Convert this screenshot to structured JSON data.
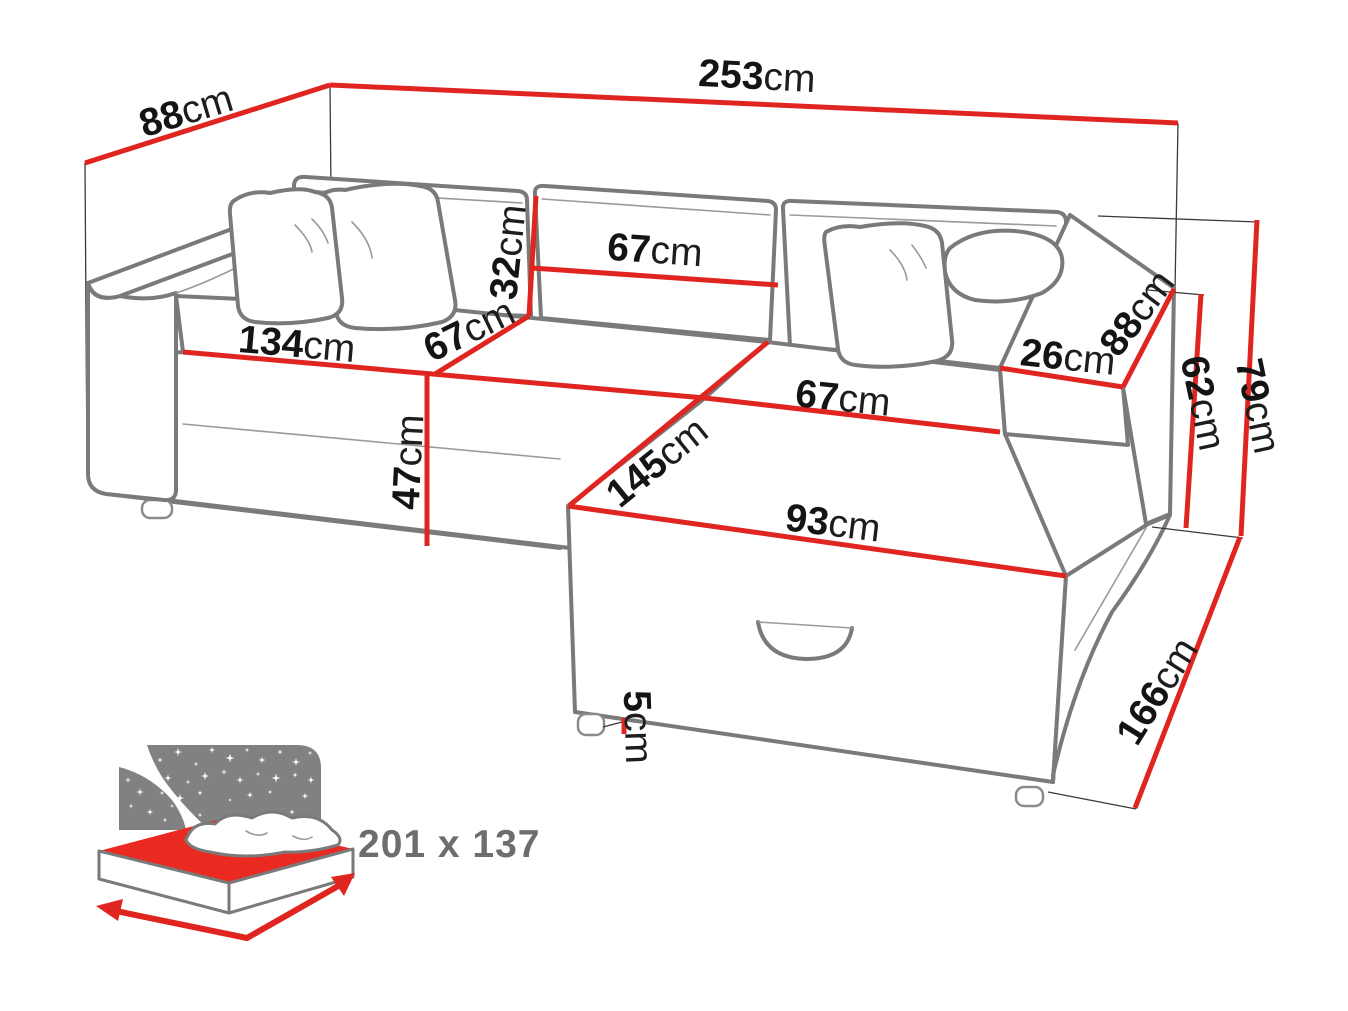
{
  "title": "Corner sofa bed dimension diagram",
  "dims": {
    "total_width": {
      "value": "253",
      "unit": "cm"
    },
    "total_depth": {
      "value": "88",
      "unit": "cm"
    },
    "backrest_height": {
      "value": "32",
      "unit": "cm"
    },
    "backrest_section_width": {
      "value": "67",
      "unit": "cm"
    },
    "seat_front_width": {
      "value": "134",
      "unit": "cm"
    },
    "seat_depth": {
      "value": "67",
      "unit": "cm"
    },
    "chaise_seat_width": {
      "value": "67",
      "unit": "cm"
    },
    "armrest_top_width": {
      "value": "26",
      "unit": "cm"
    },
    "armrest_depth": {
      "value": "88",
      "unit": "cm"
    },
    "armrest_height": {
      "value": "62",
      "unit": "cm"
    },
    "total_height": {
      "value": "79",
      "unit": "cm"
    },
    "seat_height": {
      "value": "47",
      "unit": "cm"
    },
    "chaise_length": {
      "value": "145",
      "unit": "cm"
    },
    "ottoman_front_width": {
      "value": "93",
      "unit": "cm"
    },
    "leg_height": {
      "value": "5",
      "unit": "cm"
    },
    "chaise_total_length": {
      "value": "166",
      "unit": "cm"
    }
  },
  "sleeping_area": {
    "label": "201 x 137"
  },
  "colors": {
    "dimension_red": "#e02520",
    "icon_red": "#ea2a21",
    "outline_gray": "#7a7a7a",
    "icon_gray": "#818181",
    "text_black": "#141414",
    "sleeping_text_gray": "#6d6d6d"
  }
}
